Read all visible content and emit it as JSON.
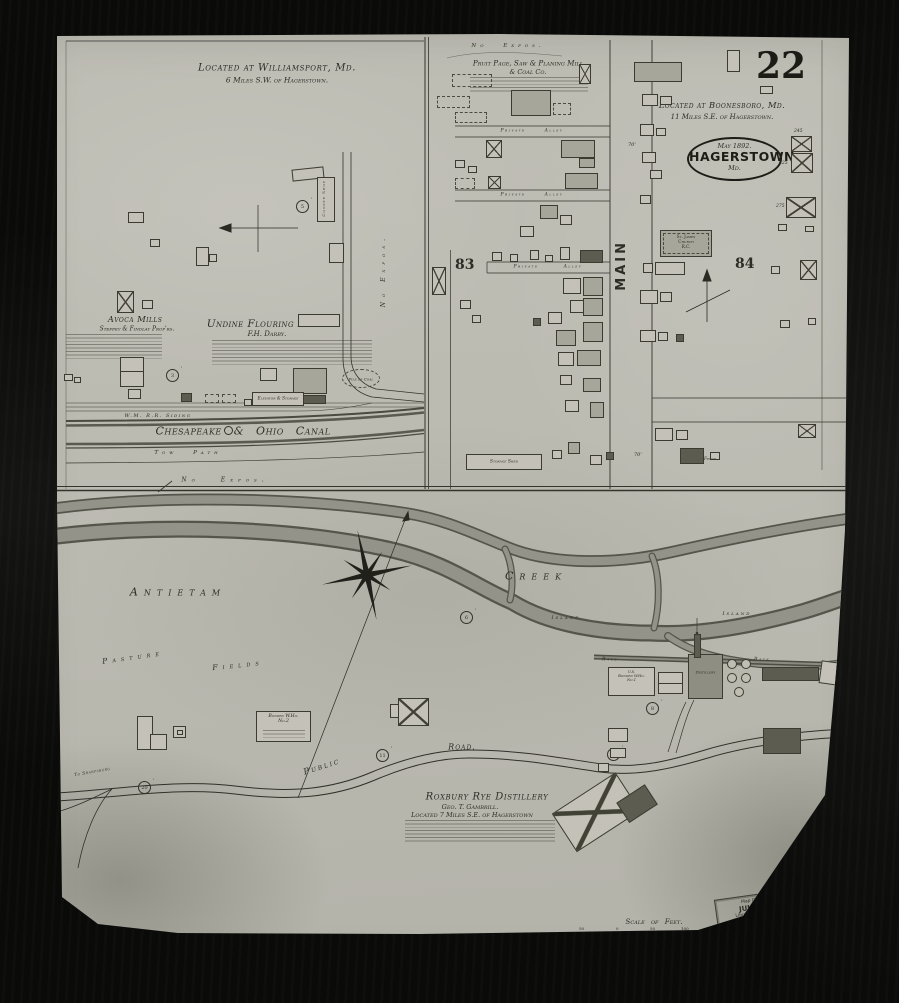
{
  "sheet_number": "22",
  "oval_stamp": {
    "date": "May 1892.",
    "city": "HAGERSTOWN",
    "state": "Md."
  },
  "library_stamp": {
    "line1": "Map Division",
    "line2": "JUL 1955",
    "line3": "Library of Congress"
  },
  "handwritten_mark": "4/16",
  "scale_bar": {
    "label": "Scale of Feet.",
    "ticks": [
      "50",
      "0",
      "50",
      "100",
      "150"
    ]
  },
  "tick": "'",
  "circled": {
    "c5": "5",
    "c3": "3",
    "c6": "6",
    "c20": "20",
    "c11": "11",
    "c8": "8",
    "c12": "12"
  },
  "williamsport": {
    "title": "Located at Williamsport, Md.",
    "subtitle": "6 Miles S.W. of Hagerstown.",
    "avoca_title": "Avoca Mills",
    "avoca_owner": "Steffey & Findlay Prop'rs.",
    "undine_title": "Undine Flouring Mills",
    "undine_owner": "F.H. Darby.",
    "cooper_shop": "Cooper Shop",
    "elevator": "Elevator & Storage",
    "pile_of_coal": "Pile of Coal",
    "rr_siding": "W.M. R.R. Siding",
    "canal": "Chesapeake & Ohio Canal",
    "tow_path": "Tow Path",
    "no_expos_right": "No Expos.",
    "no_expos_bottom": "No Expos."
  },
  "mill": {
    "no_expos": "No Expos.",
    "title": "Pruit Page, Saw & Planing Mill",
    "title2": "& Coal Co.",
    "alley": "Private Alley",
    "block": "83",
    "main_street": "MAIN",
    "dim70": "70'",
    "storage_shed": "Storage Shed"
  },
  "boonesboro": {
    "title": "Located at Boonesboro, Md.",
    "subtitle": "11 Miles S.E. of Hagerstown.",
    "block": "84",
    "church_l1": "St. James",
    "church_l2": "Church",
    "church_l3": "R.C.",
    "n245": "245",
    "n225": "225",
    "n275": "275",
    "fence": "Fence"
  },
  "creek": {
    "antietam": "Antietam",
    "creek": "Creek",
    "island1": "Island",
    "island2": "Island",
    "pasture1": "Pasture",
    "pasture2": "Fields",
    "public": "Public",
    "road": "Road.",
    "to_sharpsburg": "To Sharpsburg",
    "race1": "Race",
    "race2": "Race",
    "bonded1_l1": "U.S.",
    "bonded1_l2": "Bonded W.Ho.",
    "bonded1_l3": "No.1",
    "bonded2_l1": "Bonded W.Ho.",
    "bonded2_l2": "No.2",
    "distillery_bldg": "Distillery",
    "rox_title": "Roxbury Rye Distillery",
    "rox_owner": "Geo. T. Gambrill.",
    "rox_loc": "Located 7 Miles S.E. of Hagerstown"
  }
}
